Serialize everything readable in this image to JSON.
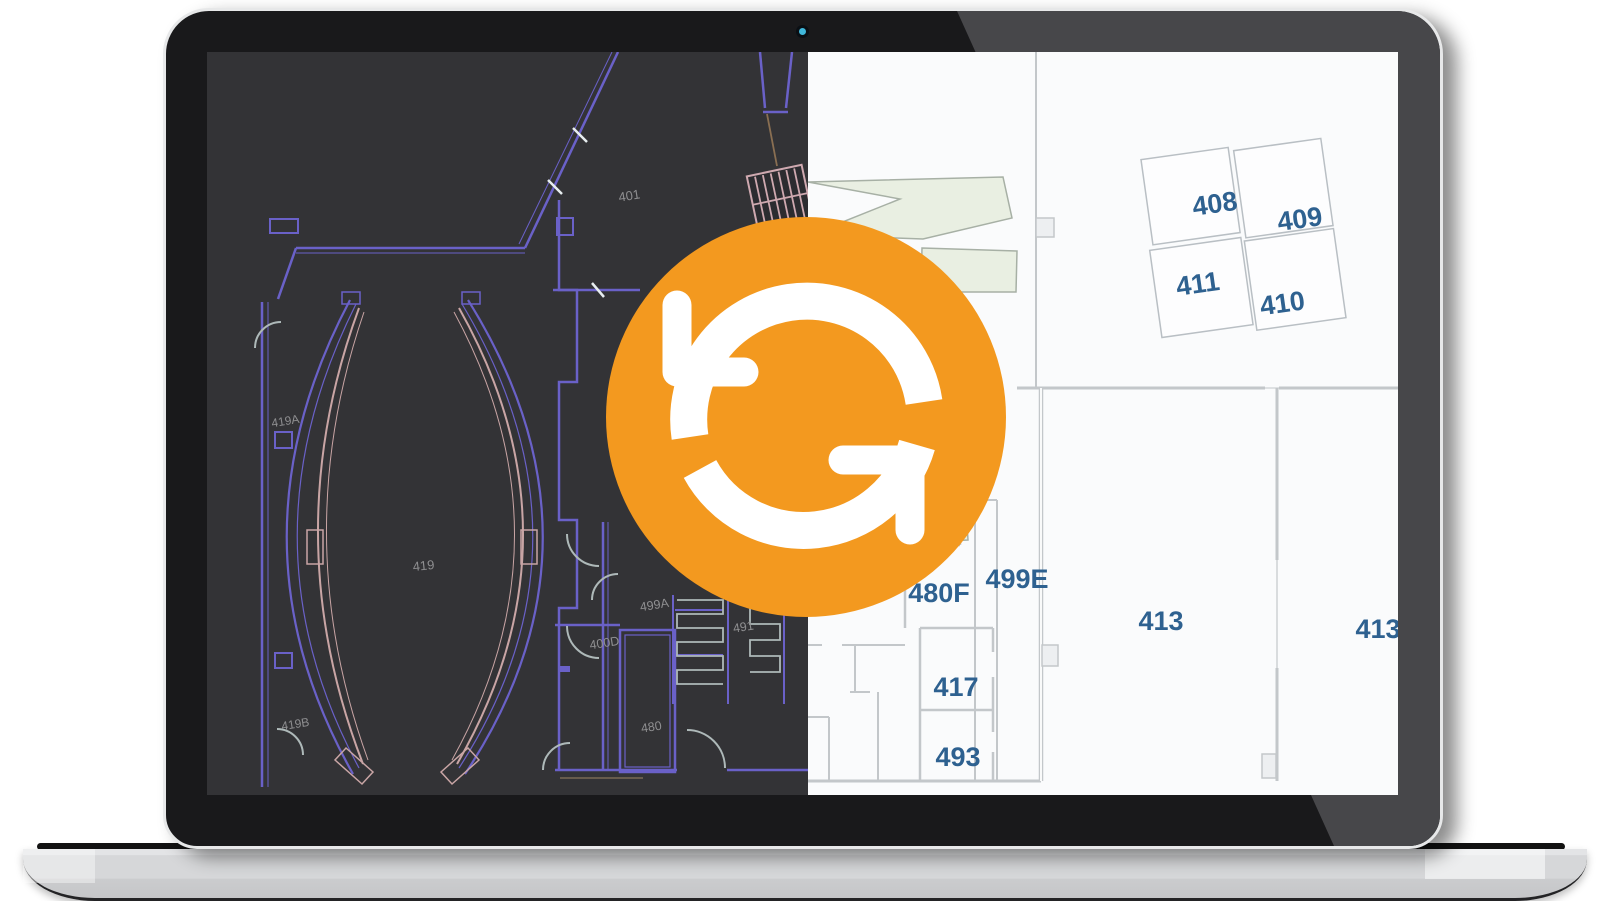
{
  "page": {
    "background": "#ffffff"
  },
  "laptop": {
    "bezel_color": "#19191b",
    "edge_color": "#e7e8e9",
    "base_color": "#d6d7d9",
    "webcam_color": "#40b8db"
  },
  "screen": {
    "cad_plan": {
      "background": "#333336",
      "wall_color": "#6a61c8",
      "secondary_wall_color": "#c9a5a5",
      "detail_color": "#aeb9b9",
      "label_color": "#8f8f91",
      "labels": [
        {
          "text": "401"
        },
        {
          "text": "419A"
        },
        {
          "text": "419"
        },
        {
          "text": "499A"
        },
        {
          "text": "400D"
        },
        {
          "text": "491"
        },
        {
          "text": "480"
        },
        {
          "text": "419B"
        }
      ]
    },
    "modern_plan": {
      "background": "#fafbfc",
      "wall_color": "#c3c7ca",
      "room_fill": "#fdfdfe",
      "zone_fill": "#e9efe2",
      "label_color": "#2e6190",
      "labels": [
        {
          "text": "408"
        },
        {
          "text": "409"
        },
        {
          "text": "411"
        },
        {
          "text": "410"
        },
        {
          "text": "499E"
        },
        {
          "text": "480F"
        },
        {
          "text": "417"
        },
        {
          "text": "493"
        },
        {
          "text": "413"
        },
        {
          "text": "413"
        }
      ]
    },
    "sync_icon": {
      "color": "#f3991f",
      "arrow_color": "#ffffff"
    }
  }
}
